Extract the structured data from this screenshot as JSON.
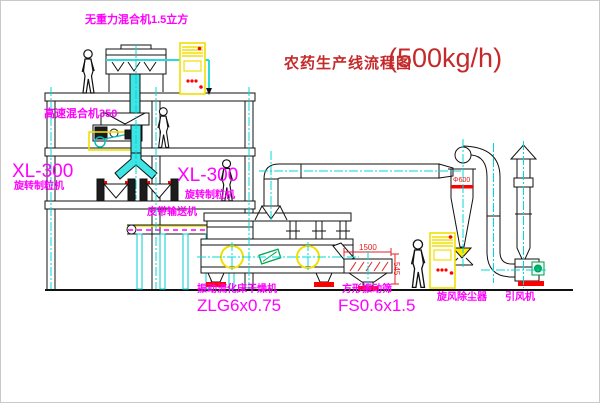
{
  "title": {
    "text": "农药生产线流程图",
    "capacity": "(500kg/h)"
  },
  "labels": {
    "gravity_mixer": "无重力混合机1.5立方",
    "high_speed_mixer": "高速混合机350",
    "granulator_left_model": "XL-300",
    "granulator_left_name": "旋转制粒机",
    "granulator_mid_model": "XL-300",
    "granulator_mid_name": "旋转制粒机",
    "belt_conveyor": "皮带输送机",
    "dryer_name": "振动流化床干燥机",
    "dryer_model": "ZLG6x0.75",
    "screen_name": "方形振动筛",
    "screen_model": "FS0.6x1.5",
    "cyclone": "旋风除尘器",
    "fan": "引风机"
  },
  "dimensions": {
    "screen_length": "1500",
    "screen_height": "545",
    "cyclone_diameter": "Φ600"
  },
  "colors": {
    "label_magenta": "#ff00ff",
    "title_red": "#c52a2a",
    "dimension_red": "#e02020",
    "pipe_cyan": "#3fe4e4",
    "centerline_cyan": "#00d8d8",
    "cabinet_yellow": "#f0e000",
    "status_red": "#ff0000"
  }
}
